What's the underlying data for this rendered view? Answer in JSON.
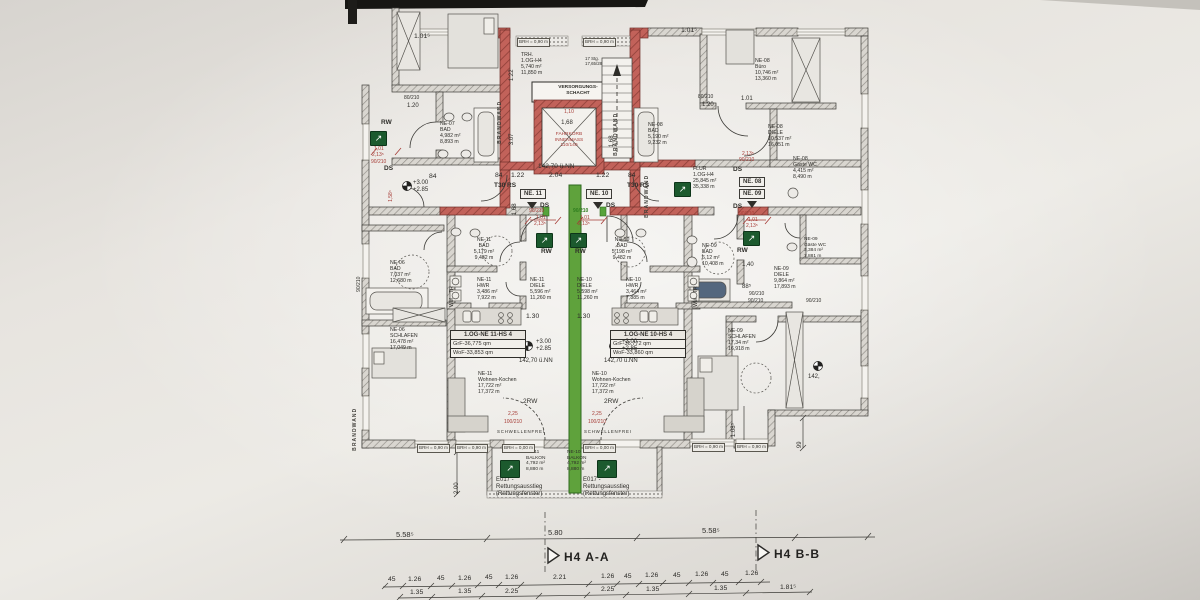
{
  "colors": {
    "wall_red": "#b5524c",
    "unit_green": "#57a33b",
    "annotation_red": "#a63c36",
    "exit_green": "#1c5a2e"
  },
  "stair": {
    "trh": "TRH.\n1.OG-H4\n5,740 m²\n11,850 m",
    "stg": "17 Stg.\n17,65/28",
    "schacht": "VERSORGUNGS-\nSCHACHT",
    "fahrkorb": "FAHRKORB\nINNENMASS\n110/140",
    "d110": "1,10",
    "d168": "1,68",
    "d168v": "1,68",
    "nn": "142,70 ü.NN",
    "d84": "84",
    "d122": "1.22",
    "d204": "2.04",
    "v122": "1.22",
    "v307": "3.07",
    "t30": "T30 RS",
    "tag11": "NE. 11",
    "tag10": "NE. 10",
    "brandwand": "BRANDWAND",
    "d1015": "1.01⁵"
  },
  "common": {
    "rw": "RW",
    "ds": "DS",
    "door90": "90/210",
    "d101": "1,01",
    "d213": "2,13⁵",
    "lvl": "+3.00\n+2.85",
    "brh090": "BRH = 0,90 m",
    "brh000": "BRH = 0,00 m",
    "d200": "2.00",
    "exit_arrow": "↗"
  },
  "ne11": {
    "bad": "NE-11\nBAD\n5,179 m²\n9,482 m",
    "hwr": "NE-11\nHWR\n3,486 m²\n7,922 m",
    "diele": "NE-11\nDIELE\n5,596 m²\n11,260 m",
    "wohnen": "NE-11\nWohnen-Kochen\n17,722 m²\n17,372 m",
    "balkon": "NE-11\nBALKON\n4,792 m²\n8,880 m",
    "title": "1.OG-NE 11-HS 4",
    "grf": "GrF-36,775 qm",
    "wof": "WoF-33,853 qm",
    "nn": "142,70 ü.NN",
    "rw2": "2RW",
    "tr": "TR",
    "wm": "WM",
    "d130": "1.30",
    "bal_door": "100/210",
    "d225": "2,25",
    "schwelle": "SCHWELLENFREI",
    "e017": "E017 -\nRettungsausstieg\n(Rettungsfenster)"
  },
  "ne10": {
    "bad": "NE-10\nBAD\n5,198 m²\n9,482 m",
    "hwr": "NE-10\nHWR\n3,464 m²\n7,885 m",
    "diele": "NE-10\nDIELE\n5,598 m²\n11,260 m",
    "wohnen": "NE-10\nWohnen-Kochen\n17,722 m²\n17,372 m",
    "balkon": "NE-10\nBALKON\n4,792 m²\n8,880 m",
    "title": "1.OG-NE 10-HS 4",
    "grf": "GrF-36,772 qm",
    "wof": "WoF-33,860 qm"
  },
  "west": {
    "ne07_bad": "NE-07\nBAD\n4,982 m²\n8,893 m",
    "ne06_bad": "NE-06\nBAD\n7,037 m²\n12,680 m",
    "ne06_schlafen": "NE-06\nSCHLAFEN\n16,478 m²\n17,049 m",
    "door80": "80/210",
    "d120": "1.20",
    "d1585": "1,58⁵",
    "d84": "84",
    "v90210": "90/210"
  },
  "east": {
    "ne08_bad": "NE-08\nBAD\n5,190 m²\n9,232 m",
    "ne08_buero": "NE-08\nBüro\n10,746 m²\n13,360 m",
    "ne08_diele": "NE-08\nDIELE\n10,537 m²\n16,051 m",
    "ne08_gwc": "NE-08\nGäste WC\n4,415 m²\n8,490 m",
    "flur": "FLUR\n1.OG-H4\n25,845 m²\n35,338 m",
    "tag08": "NE. 08",
    "tag09": "NE. 09",
    "ne09_bad": "NE-09\nBAD\n6,12 m²\n10,408 m",
    "ne09_gwc": "NE-09\nGäste WC\n3,384 m²\n7,881 m",
    "ne09_diele": "NE-09\nDIELE\n9,864 m²\n17,893 m",
    "ne09_schlafen": "NE-09\nSCHLAFEN\n17,34 m²\n16,918 m",
    "d140": "1,40",
    "d885": "88⁵",
    "d120": "1.20",
    "d101": "1.01",
    "door80": "80/210",
    "nn_part": "142,",
    "d99": "99",
    "d1085": "1.08⁵"
  },
  "bottom": {
    "c1a": "5.58⁵",
    "c1b": "5.80",
    "c1c": "5.58⁵",
    "secA": "H4 A-A",
    "secB": "H4 B-B",
    "r1": [
      "45",
      "1.26",
      "45",
      "1.26",
      "45",
      "1.26",
      "2.21",
      "1.26",
      "45",
      "1.26",
      "45",
      "1.26",
      "45",
      "1.26"
    ],
    "r2": [
      "1.35",
      "1.35",
      "2.25",
      "2.25",
      "1.35",
      "1.35",
      "1.81⁵"
    ]
  }
}
